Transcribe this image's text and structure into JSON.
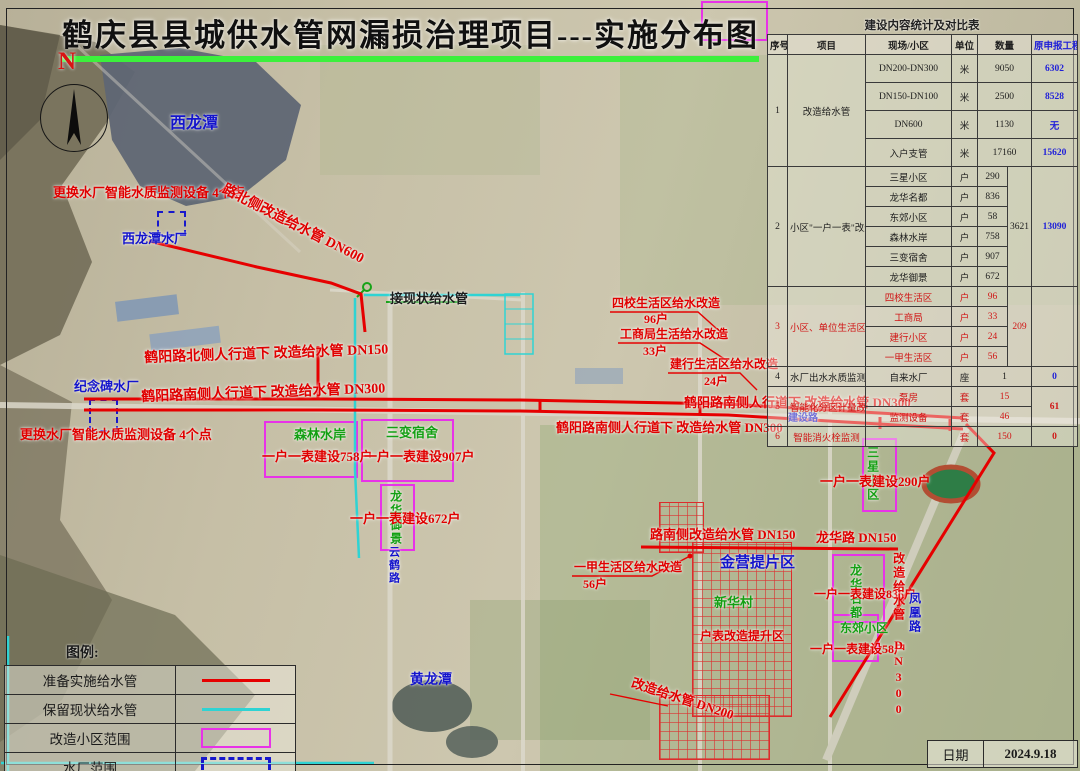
{
  "title": {
    "text": "鹤庆县县城供水管网漏损治理项目---实施分布图"
  },
  "compass": {
    "label": "N"
  },
  "table": {
    "title": "建设内容统计及对比表",
    "columns": [
      "序号",
      "项目",
      "现场/小区",
      "单位",
      "数量",
      "原申报工程量"
    ],
    "groups": [
      {
        "no": "1",
        "project": "改造给水管",
        "red": false,
        "tall": true,
        "rows": [
          {
            "site": "DN200-DN300",
            "unit": "米",
            "qty": "9050",
            "declared": "6302"
          },
          {
            "site": "DN150-DN100",
            "unit": "米",
            "qty": "2500",
            "declared": "8528"
          },
          {
            "site": "DN600",
            "unit": "米",
            "qty": "1130",
            "declared": "无"
          },
          {
            "site": "入户支管",
            "unit": "米",
            "qty": "17160",
            "declared": "15620"
          }
        ]
      },
      {
        "no": "2",
        "project": "小区\"一户一表\"改造建设",
        "red": false,
        "total": "3621",
        "declared_merged": "13090",
        "rows": [
          {
            "site": "三星小区",
            "unit": "户",
            "qty": "290"
          },
          {
            "site": "龙华名都",
            "unit": "户",
            "qty": "836"
          },
          {
            "site": "东郊小区",
            "unit": "户",
            "qty": "58"
          },
          {
            "site": "森林水岸",
            "unit": "户",
            "qty": "758"
          },
          {
            "site": "三变宿舍",
            "unit": "户",
            "qty": "907"
          },
          {
            "site": "龙华御景",
            "unit": "户",
            "qty": "672"
          }
        ]
      },
      {
        "no": "3",
        "project": "小区、单位生活区给水改造",
        "red": true,
        "total": "209",
        "declared_merged": "",
        "rows": [
          {
            "site": "四校生活区",
            "unit": "户",
            "qty": "96"
          },
          {
            "site": "工商局",
            "unit": "户",
            "qty": "33"
          },
          {
            "site": "建行小区",
            "unit": "户",
            "qty": "24"
          },
          {
            "site": "一甲生活区",
            "unit": "户",
            "qty": "56"
          }
        ]
      },
      {
        "no": "4",
        "project": "水厂出水水质监测",
        "red": false,
        "rows": [
          {
            "site": "自来水厂",
            "unit": "座",
            "qty": "1",
            "declared": "0"
          }
        ]
      },
      {
        "no": "5",
        "project": "智能化分区计量改造",
        "red": true,
        "declared_merged": "61",
        "rows": [
          {
            "site": "泵房",
            "unit": "套",
            "qty": "15"
          },
          {
            "site": "监测设备",
            "unit": "套",
            "qty": "46"
          }
        ]
      },
      {
        "no": "6",
        "project": "智能消火栓监测",
        "red": true,
        "rows": [
          {
            "site": "",
            "unit": "套",
            "qty": "150",
            "declared": "0"
          }
        ]
      }
    ]
  },
  "legend": {
    "title": "图例:",
    "items": [
      {
        "label": "准备实施给水管",
        "swatch": "red-line"
      },
      {
        "label": "保留现状给水管",
        "swatch": "cyan-line"
      },
      {
        "label": "改造小区范围",
        "swatch": "magenta-box"
      },
      {
        "label": "水厂范围",
        "swatch": "blue-dashed-box"
      }
    ]
  },
  "datebox": {
    "label": "日期",
    "value": "2024.9.18"
  },
  "map": {
    "colors": {
      "red": "#e00000",
      "blue": "#1414cc",
      "green": "#13a013",
      "black": "#1c1c1c",
      "cyan": "#18c8c8",
      "magenta": "#e832e8"
    },
    "labels": [
      {
        "text": "西龙潭",
        "x": 170,
        "y": 116,
        "color": "blue",
        "size": 16
      },
      {
        "text": "更换水厂智能水质监测设备 4个点",
        "x": 53,
        "y": 186,
        "color": "red",
        "size": 13
      },
      {
        "text": "西龙潭水厂",
        "x": 122,
        "y": 232,
        "color": "blue",
        "size": 13
      },
      {
        "text": "路北侧改造给水管 DN600",
        "x": 226,
        "y": 183,
        "color": "red",
        "size": 14,
        "rot": 27
      },
      {
        "text": "接现状给水管",
        "x": 390,
        "y": 292,
        "color": "black",
        "size": 13
      },
      {
        "text": "纪念碑水厂",
        "x": 74,
        "y": 380,
        "color": "blue",
        "size": 13
      },
      {
        "text": "更换水厂智能水质监测设备 4个点",
        "x": 20,
        "y": 428,
        "color": "red",
        "size": 13
      },
      {
        "text": "鹤阳路北侧人行道下 改造给水管 DN150",
        "x": 144,
        "y": 352,
        "color": "red",
        "size": 14,
        "rot": -2
      },
      {
        "text": "鹤阳路南侧人行道下 改造给水管 DN300",
        "x": 141,
        "y": 391,
        "color": "red",
        "size": 14,
        "rot": -2
      },
      {
        "text": "四校生活区给水改造",
        "x": 612,
        "y": 297,
        "color": "red",
        "size": 12
      },
      {
        "text": "96户",
        "x": 644,
        "y": 313,
        "color": "red",
        "size": 12
      },
      {
        "text": "工商局生活给水改造",
        "x": 620,
        "y": 328,
        "color": "red",
        "size": 12
      },
      {
        "text": "33户",
        "x": 643,
        "y": 345,
        "color": "red",
        "size": 12
      },
      {
        "text": "建行生活区给水改造",
        "x": 670,
        "y": 358,
        "color": "red",
        "size": 12
      },
      {
        "text": "24户",
        "x": 704,
        "y": 375,
        "color": "red",
        "size": 12
      },
      {
        "text": "鹤阳路南侧人行道下 改造给水管 DN300",
        "x": 684,
        "y": 396,
        "color": "red",
        "size": 13
      },
      {
        "text": "鹤阳路南侧人行道下 改造给水管 DN300",
        "x": 556,
        "y": 421,
        "color": "red",
        "size": 13
      },
      {
        "text": "森林水岸",
        "x": 294,
        "y": 428,
        "color": "green",
        "size": 13
      },
      {
        "text": "一户一表建设758户",
        "x": 262,
        "y": 450,
        "color": "red",
        "size": 13
      },
      {
        "text": "三变宿舍",
        "x": 386,
        "y": 426,
        "color": "green",
        "size": 13
      },
      {
        "text": "一户一表建设907户",
        "x": 364,
        "y": 450,
        "color": "red",
        "size": 13
      },
      {
        "text": "龙华御景",
        "x": 389,
        "y": 490,
        "color": "green",
        "size": 12,
        "vertical": true
      },
      {
        "text": "一户一表建设672户",
        "x": 350,
        "y": 512,
        "color": "red",
        "size": 13
      },
      {
        "text": "一甲生活区给水改造",
        "x": 574,
        "y": 561,
        "color": "red",
        "size": 12
      },
      {
        "text": "56户",
        "x": 583,
        "y": 578,
        "color": "red",
        "size": 12
      },
      {
        "text": "路南侧改造给水管 DN150",
        "x": 650,
        "y": 528,
        "color": "red",
        "size": 13
      },
      {
        "text": "龙华路 DN150",
        "x": 816,
        "y": 531,
        "color": "red",
        "size": 13
      },
      {
        "text": "金营提片区",
        "x": 720,
        "y": 556,
        "color": "blue",
        "size": 15
      },
      {
        "text": "三星小区",
        "x": 866,
        "y": 446,
        "color": "green",
        "size": 12,
        "vertical": true
      },
      {
        "text": "一户一表建设290户",
        "x": 820,
        "y": 475,
        "color": "red",
        "size": 13
      },
      {
        "text": "龙华名都",
        "x": 849,
        "y": 564,
        "color": "green",
        "size": 12,
        "vertical": true
      },
      {
        "text": "一户一表建设836户",
        "x": 814,
        "y": 588,
        "color": "red",
        "size": 12
      },
      {
        "text": "东郊小区",
        "x": 840,
        "y": 622,
        "color": "green",
        "size": 12
      },
      {
        "text": "一户一表建设58户",
        "x": 810,
        "y": 643,
        "color": "red",
        "size": 12
      },
      {
        "text": "新华村",
        "x": 714,
        "y": 596,
        "color": "green",
        "size": 13
      },
      {
        "text": "户表改造提升区",
        "x": 700,
        "y": 630,
        "color": "red",
        "size": 12
      },
      {
        "text": "改造给水管 DN200",
        "x": 634,
        "y": 676,
        "color": "red",
        "size": 13,
        "rot": 18
      },
      {
        "text": "改造给水管 DN300",
        "x": 892,
        "y": 552,
        "color": "red",
        "size": 12,
        "vertical": true
      },
      {
        "text": "凤凰路",
        "x": 908,
        "y": 592,
        "color": "blue",
        "size": 12,
        "vertical": true
      },
      {
        "text": "黄龙潭",
        "x": 410,
        "y": 674,
        "color": "blue",
        "size": 14
      },
      {
        "text": "云鹤路",
        "x": 387,
        "y": 546,
        "color": "blue",
        "size": 11,
        "vertical": true
      },
      {
        "text": "建设路",
        "x": 788,
        "y": 414,
        "color": "blue",
        "size": 10
      }
    ],
    "zones": [
      {
        "type": "magenta",
        "x": 264,
        "y": 421,
        "w": 90,
        "h": 53
      },
      {
        "type": "magenta",
        "x": 361,
        "y": 419,
        "w": 89,
        "h": 59
      },
      {
        "type": "magenta",
        "x": 380,
        "y": 484,
        "w": 31,
        "h": 63
      },
      {
        "type": "magenta",
        "x": 862,
        "y": 438,
        "w": 31,
        "h": 70
      },
      {
        "type": "magenta",
        "x": 832,
        "y": 554,
        "w": 49,
        "h": 65
      },
      {
        "type": "magenta",
        "x": 832,
        "y": 614,
        "w": 43,
        "h": 44
      },
      {
        "type": "magenta",
        "x": 701,
        "y": 1,
        "w": 63,
        "h": 36
      },
      {
        "type": "blue-dashed",
        "x": 157,
        "y": 211,
        "w": 25,
        "h": 21
      },
      {
        "type": "blue-dashed",
        "x": 89,
        "y": 399,
        "w": 25,
        "h": 29
      },
      {
        "type": "red-grid",
        "x": 659,
        "y": 502,
        "w": 43,
        "h": 49
      },
      {
        "type": "red-grid",
        "x": 692,
        "y": 542,
        "w": 98,
        "h": 173
      },
      {
        "type": "red-grid",
        "x": 659,
        "y": 695,
        "w": 109,
        "h": 63
      }
    ]
  }
}
